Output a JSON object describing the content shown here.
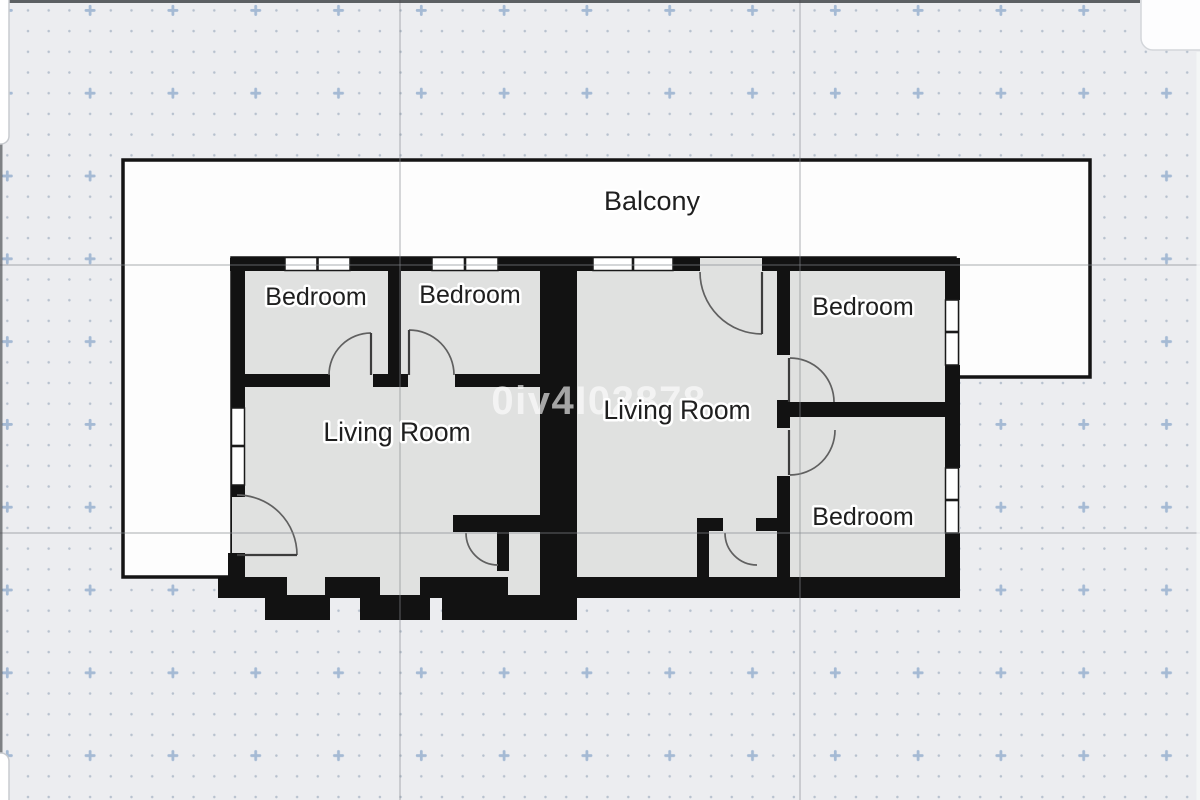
{
  "floorplan": {
    "balcony_label": "Balcony",
    "watermark": "0iv4I02878",
    "rooms": [
      {
        "id": "bedroom-top-left",
        "label": "Bedroom"
      },
      {
        "id": "bedroom-top-middle",
        "label": "Bedroom"
      },
      {
        "id": "bedroom-top-right",
        "label": "Bedroom"
      },
      {
        "id": "bedroom-bottom-right",
        "label": "Bedroom"
      },
      {
        "id": "living-room-left",
        "label": "Living Room"
      },
      {
        "id": "living-room-right",
        "label": "Living Room"
      }
    ],
    "colors": {
      "canvas": "#ecedf0",
      "grid_dot": "#b7c1ce",
      "grid_marker": "#a5bad4",
      "gridline": "#85898e",
      "wall": "#121212",
      "room_fill": "#e0e1e0",
      "balcony_fill": "#fdfdfd",
      "door_arc": "#606060",
      "label_text": "#1f1f1f",
      "label_halo": "#ffffff",
      "watermark_text": "#ffffff",
      "edge_dark": "#43464a",
      "edge_panel": "#fdfdfe"
    }
  }
}
